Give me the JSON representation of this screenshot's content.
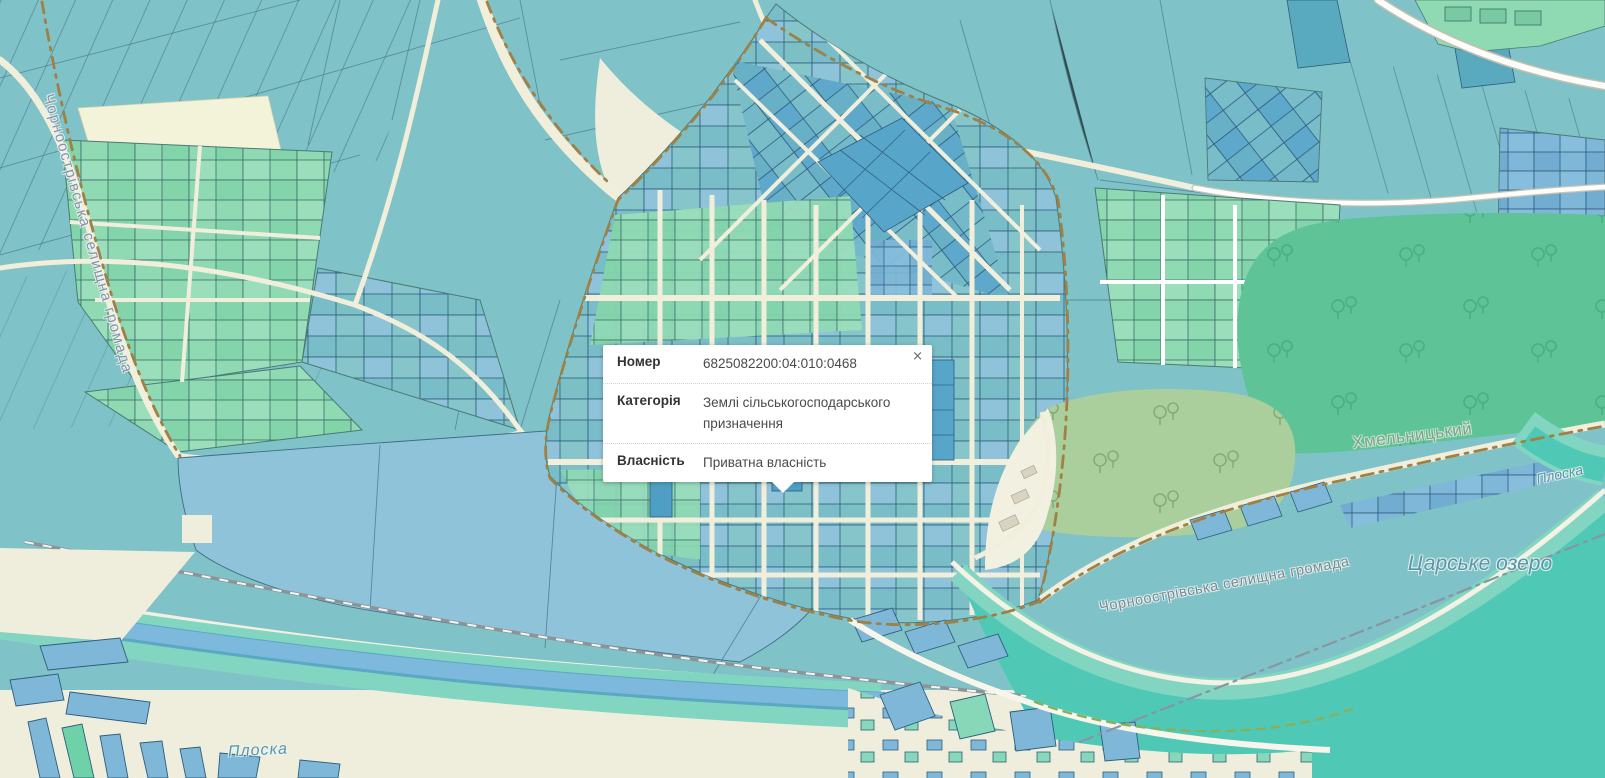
{
  "popup": {
    "close_label": "×",
    "rows": [
      {
        "label": "Номер",
        "value": "6825082200:04:010:0468"
      },
      {
        "label": "Категорія",
        "value": "Землі сільськогосподарського призначення"
      },
      {
        "label": "Власність",
        "value": "Приватна власність"
      }
    ]
  },
  "map_labels": {
    "municipality_boundary_left": "Чорноострівська селищна громада",
    "municipality_boundary_river": "Чорноострівська селищна громада",
    "lake": "Царське озеро",
    "river_southwest": "Плоска",
    "river_east": "Плоска",
    "city_forest": "Хмельницький"
  },
  "colors": {
    "farmland_teal": "#7fc2c7",
    "parcel_green": "#8fd9b3",
    "parcel_blue": "#7fb7d8",
    "selected_parcel_blue": "#4f9fc4",
    "forest_green": "#5ec397",
    "park_green": "#abce9d",
    "water_teal": "#4fc9b6",
    "water_blue": "#7cb9dc",
    "road_cream": "#f1eedb",
    "boundary_brown": "#a08045"
  }
}
